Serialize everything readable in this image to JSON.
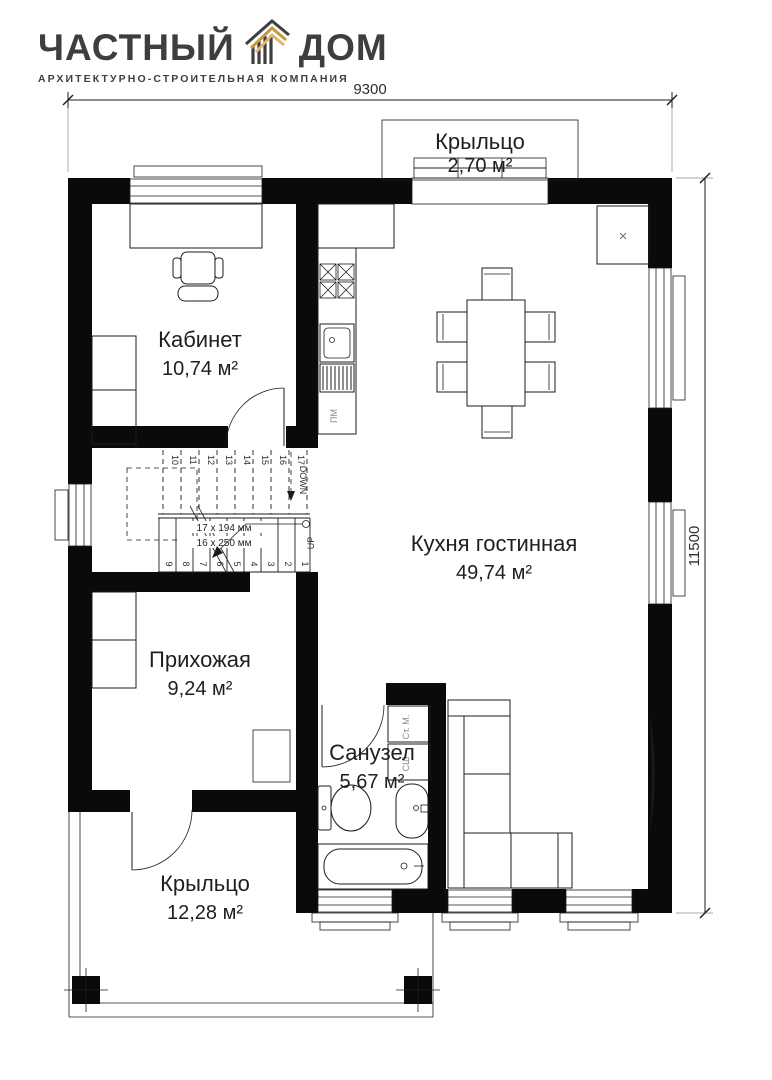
{
  "brand": {
    "name_left": "ЧАСТНЫЙ",
    "name_right": "ДОМ",
    "tagline": "АРХИТЕКТУРНО-СТРОИТЕЛЬНАЯ КОМПАНИЯ"
  },
  "colors": {
    "ink": "#3e3e3e",
    "gold": "#c49a3c",
    "gold_light": "#d9b878",
    "wall": "#0a0a0a"
  },
  "dimensions": {
    "width_mm": "9300",
    "height_mm": "11500"
  },
  "rooms": [
    {
      "name": "Крыльцо",
      "area": "2,70 м²"
    },
    {
      "name": "Кабинет",
      "area": "10,74 м²"
    },
    {
      "name": "Кухня гостинная",
      "area": "49,74 м²"
    },
    {
      "name": "Прихожая",
      "area": "9,24 м²"
    },
    {
      "name": "Санузел",
      "area": "5,67 м²"
    },
    {
      "name": "Крыльцо",
      "area": "12,28 м²"
    }
  ],
  "stairs": {
    "up": "UP",
    "down": "DOWN",
    "riser_note": "17 x 194 мм",
    "tread_note": "16 x 250 мм",
    "lower_steps": [
      "1",
      "2",
      "3",
      "4",
      "5",
      "6",
      "7",
      "8",
      "9"
    ],
    "upper_steps": [
      "10",
      "11",
      "12",
      "13",
      "14",
      "15",
      "16",
      "17"
    ]
  },
  "appliances": {
    "washer": "Ст. М.",
    "dryer": "СШ",
    "dishwasher": "ПМ"
  },
  "marks": {
    "wardrobe_x": "×"
  }
}
